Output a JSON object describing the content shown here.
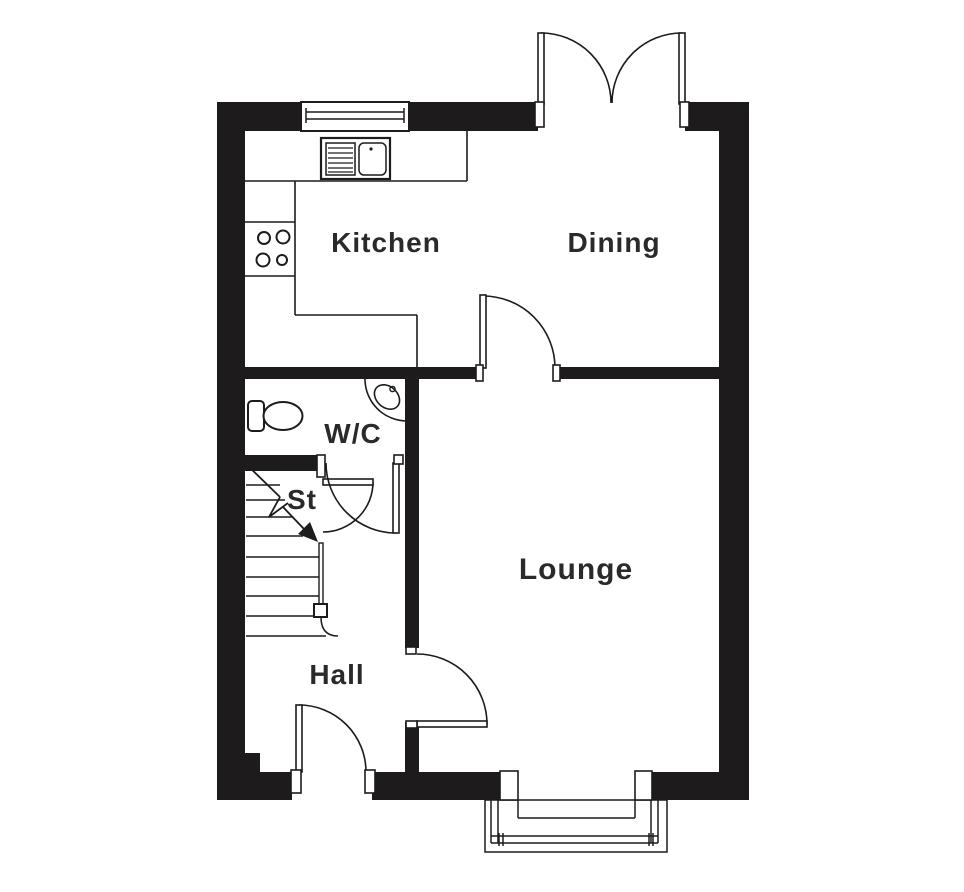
{
  "floorplan": {
    "rooms": {
      "kitchen": {
        "label": "Kitchen"
      },
      "dining": {
        "label": "Dining"
      },
      "wc": {
        "label": "W/C"
      },
      "stairs": {
        "label": "St"
      },
      "lounge": {
        "label": "Lounge"
      },
      "hall": {
        "label": "Hall"
      }
    },
    "fixtures": [
      "kitchen-window",
      "sink-drainer-unit",
      "hob-four-rings",
      "worktop",
      "french-doors",
      "internal-door-dining-lounge",
      "wc-door",
      "store-door",
      "hall-lounge-door",
      "front-door",
      "toilet",
      "corner-basin",
      "staircase-with-up-arrow",
      "bay-window"
    ],
    "colors": {
      "wall": "#1d1b1b",
      "line": "#1d1b1b",
      "text": "#2b2a29",
      "background": "#ffffff"
    }
  }
}
